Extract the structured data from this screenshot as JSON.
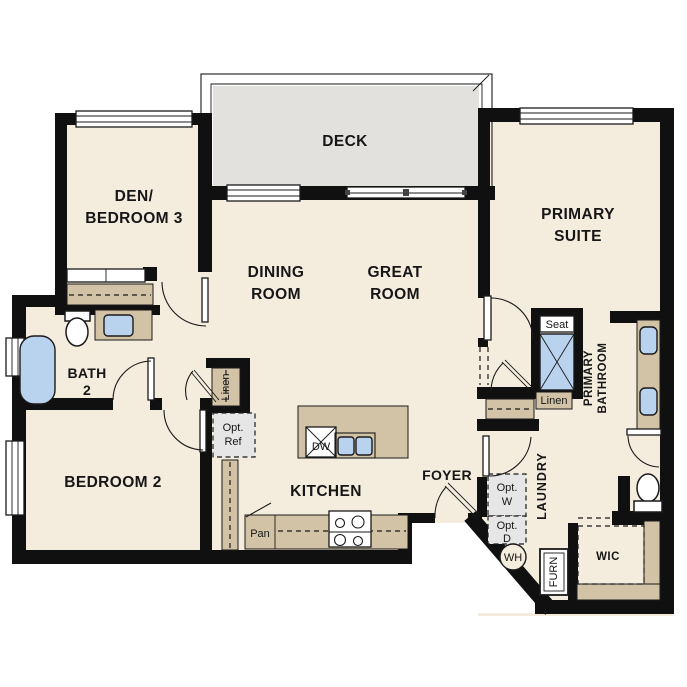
{
  "colors": {
    "background": "#ffffff",
    "floor": "#f4edde",
    "deck": "#e2e1de",
    "wall": "#101010",
    "counter": "#d2c3a6",
    "fixture": "#b9d3ee",
    "appliance": "#e6e6e6"
  },
  "rooms": {
    "deck": "DECK",
    "den_line1": "DEN/",
    "den_line2": "BEDROOM 3",
    "dining_line1": "DINING",
    "dining_line2": "ROOM",
    "great_line1": "GREAT",
    "great_line2": "ROOM",
    "primary_suite_line1": "PRIMARY",
    "primary_suite_line2": "SUITE",
    "bath2_line1": "BATH",
    "bath2_line2": "2",
    "bedroom2": "BEDROOM 2",
    "kitchen": "KITCHEN",
    "foyer": "FOYER",
    "laundry": "LAUNDRY",
    "wic": "WIC",
    "primary_bath_line1": "PRIMARY",
    "primary_bath_line2": "BATHROOM"
  },
  "labels": {
    "seat": "Seat",
    "linen_hall": "Linen",
    "linen_primary": "Linen",
    "opt_ref_line1": "Opt.",
    "opt_ref_line2": "Ref",
    "opt_washer_line1": "Opt.",
    "opt_washer_line2": "W",
    "opt_dryer_line1": "Opt.",
    "opt_dryer_line2": "D",
    "water_heater": "WH",
    "furnace": "FURN",
    "pantry": "Pan",
    "dishwasher": "DW"
  }
}
